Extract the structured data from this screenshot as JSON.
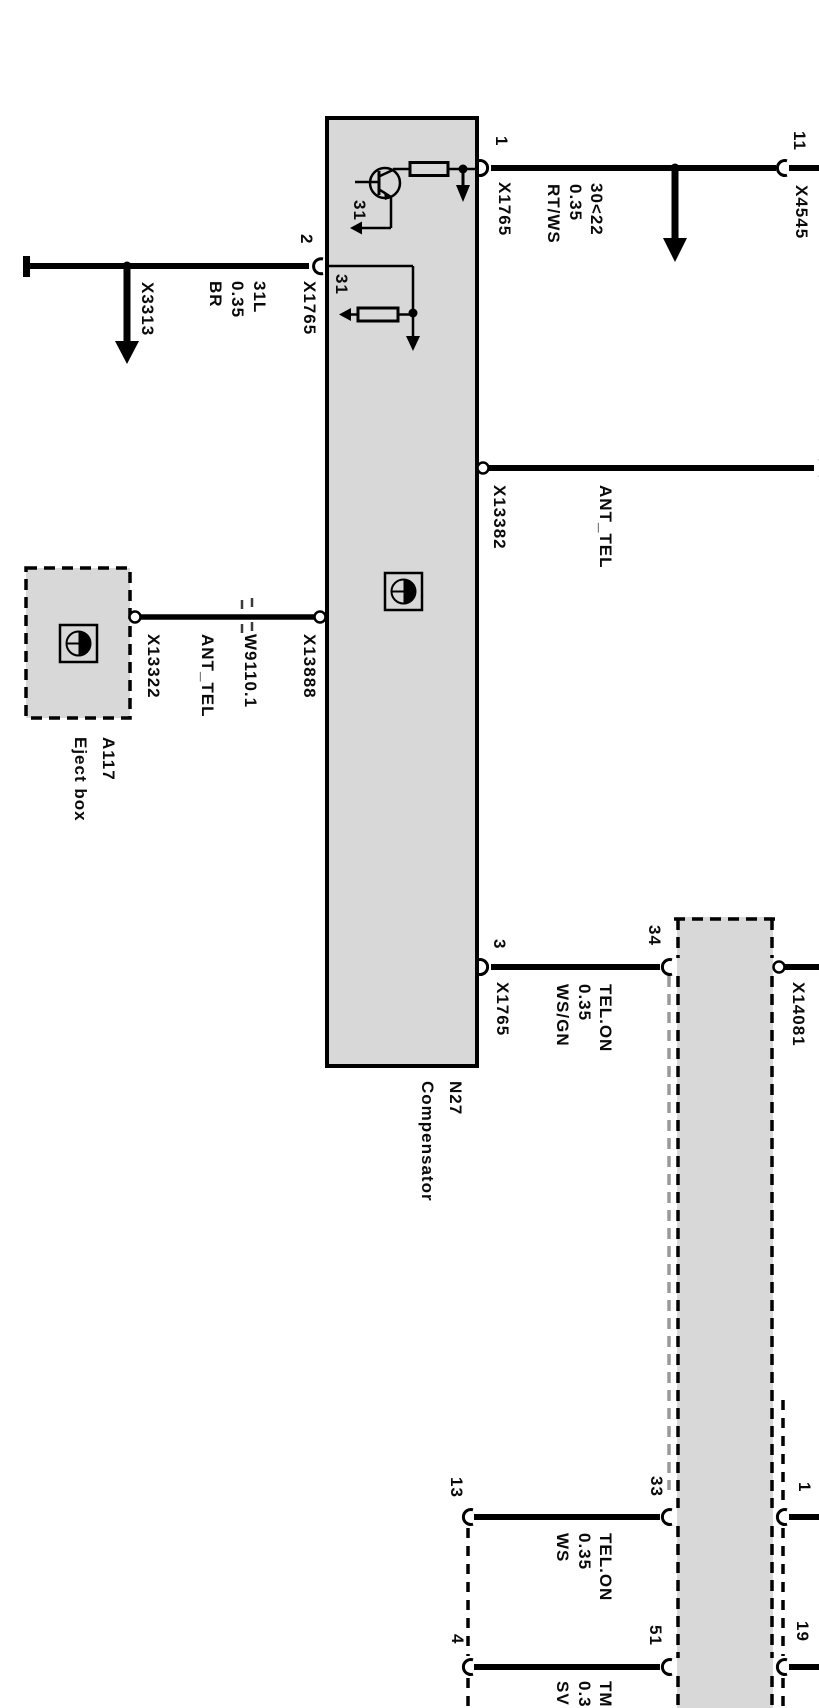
{
  "colors": {
    "background": "#ffffff",
    "line": "#000000",
    "module_fill": "#d8d8d8",
    "ghost_dash": "#9a9a9a"
  },
  "modules": {
    "compensator": {
      "code": "N27",
      "name": "Compensator"
    },
    "eject_box": {
      "code": "A117",
      "name": "Eject box"
    }
  },
  "pins": {
    "pin1": "1",
    "pin2": "2",
    "pin3": "3",
    "pin11": "11",
    "pin34": "34",
    "pin33": "33",
    "pin51": "51",
    "pin13": "13",
    "pin4": "4",
    "pin1_right": "1",
    "pin19": "19"
  },
  "connectors": {
    "x1765_pin1": "X1765",
    "x1765_pin2": "X1765",
    "x1765_pin3": "X1765",
    "x4545": "X4545",
    "x3313": "X3313",
    "x13382": "X13382",
    "x13888": "X13888",
    "x13322": "X13322",
    "x14081": "X14081",
    "splice": "W9110.1"
  },
  "grounds": {
    "upper": "31",
    "lower": "31"
  },
  "wires": {
    "kl31l": {
      "lines": [
        "31L",
        "0.35",
        "BR"
      ]
    },
    "kl30": {
      "lines": [
        "30<22",
        "0.35",
        "RT/WS"
      ]
    },
    "ant_tel_main": {
      "label": "ANT_TEL"
    },
    "ant_tel_eject": {
      "label": "ANT_TEL"
    },
    "tel_on_main": {
      "lines": [
        "TEL.ON",
        "0.35",
        "WS/GN"
      ]
    },
    "tel_on_lower": {
      "lines": [
        "TEL.ON",
        "0.35",
        "WS"
      ]
    },
    "tm_lower": {
      "lines": [
        "TM",
        "0.3",
        "SV"
      ]
    }
  }
}
